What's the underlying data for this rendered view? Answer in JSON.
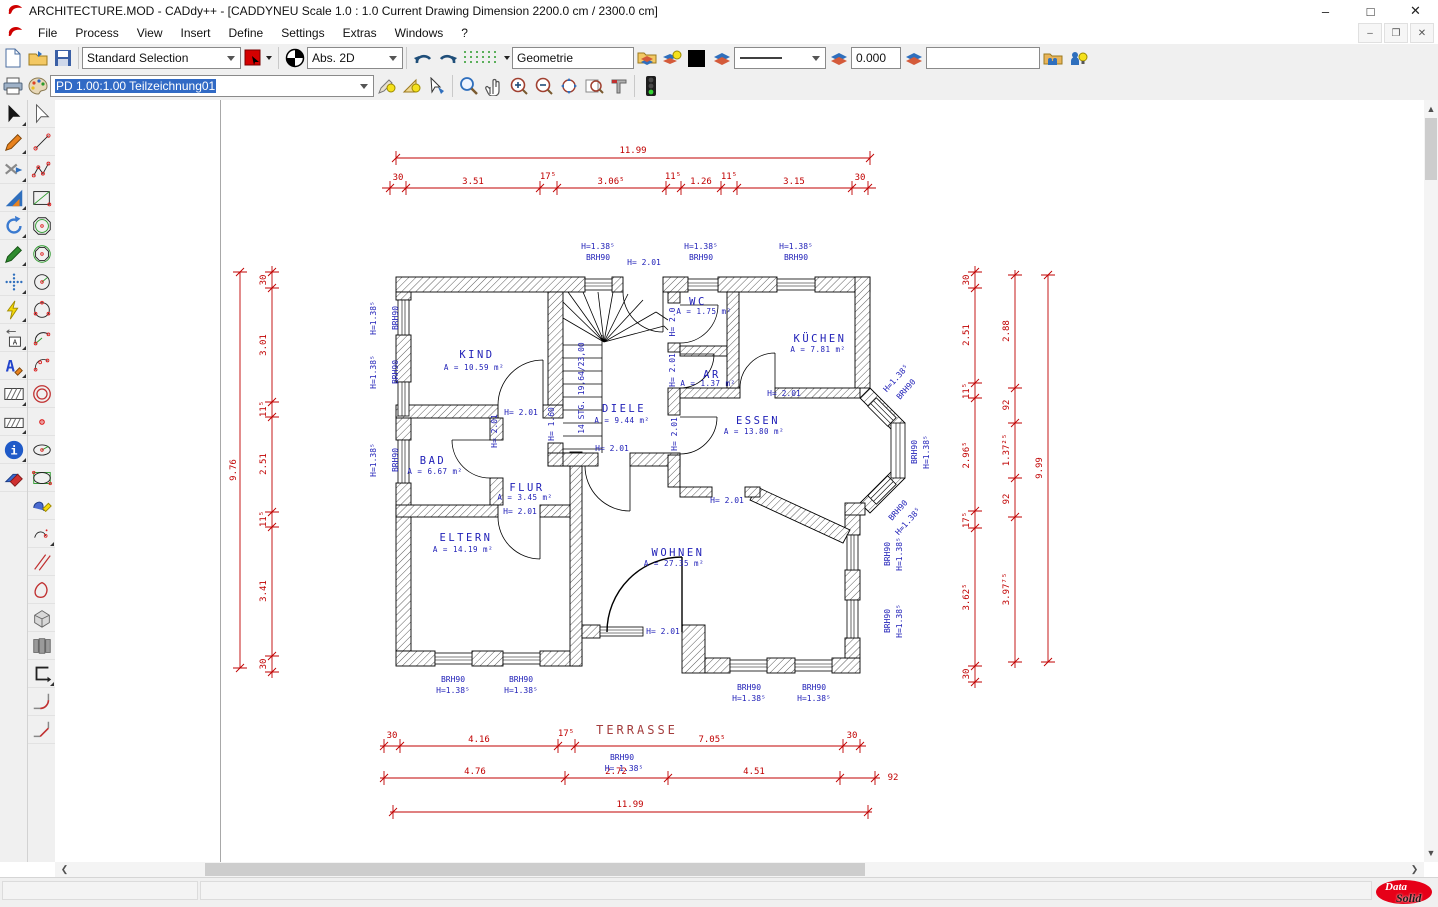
{
  "window": {
    "title": "ARCHITECTURE.MOD  -  CADdy++  - [CADDYNEU   Scale 1.0 : 1.0   Current Drawing Dimension 2200.0 cm / 2300.0 cm]",
    "minimize": "–",
    "maximize": "□",
    "close": "✕"
  },
  "menu": {
    "items": [
      "File",
      "Process",
      "View",
      "Insert",
      "Define",
      "Settings",
      "Extras",
      "Windows",
      "?"
    ]
  },
  "toolbar1": {
    "selection_combo": "Standard Selection",
    "coord_combo": "Abs. 2D",
    "layer_input": "Geometrie",
    "angle_input": "0.000",
    "extra_input": ""
  },
  "toolbar2": {
    "drawing_combo": "PD 1.00:1.00 Teilzeichnung01"
  },
  "plan": {
    "rooms": [
      {
        "name": "KIND",
        "area": "A = 10.59 m²"
      },
      {
        "name": "DIELE",
        "area": "A = 9.44 m²"
      },
      {
        "name": "WC",
        "area": "A = 1.75 m²"
      },
      {
        "name": "KÜCHEN",
        "area": "A = 7.81 m²"
      },
      {
        "name": "AR",
        "area": "A = 1.37 m²"
      },
      {
        "name": "ESSEN",
        "area": "A = 13.80 m²"
      },
      {
        "name": "BAD",
        "area": "A = 6.67 m²"
      },
      {
        "name": "FLUR",
        "area": "A = 3.45 m²"
      },
      {
        "name": "ELTERN",
        "area": "A = 14.19 m²"
      },
      {
        "name": "WOHNEN",
        "area": "A = 27.35 m²"
      }
    ],
    "terrasse": "TERRASSE",
    "stairs": "14 STG. 19,64/23,00",
    "ann": {
      "h201": "H= 2.01",
      "h20": "H= 2.0",
      "h138": "H=1.38⁵",
      "h138sp": "H= 1.38⁵",
      "brh": "BRH90",
      "h160": "H= 1.60"
    },
    "dims": {
      "top_total": "11.99",
      "top_chain": [
        "30",
        "3.51",
        "17⁵",
        "3.06⁵",
        "11⁵",
        "1.26",
        "11⁵",
        "3.15",
        "30"
      ],
      "left_total": "9.76",
      "left_chain": [
        "30",
        "3.01",
        "11⁵",
        "2.51",
        "11⁵",
        "3.41",
        "30"
      ],
      "right_chain1": [
        "30",
        "2.51",
        "11⁵",
        "2.96⁵",
        "17⁵",
        "3.62⁵",
        "30"
      ],
      "right_chain2": [
        "2.88",
        "92",
        "1.37²⁵",
        "92",
        "3.97⁷⁵"
      ],
      "right_total": "9.99",
      "bottom_chain1": [
        "30",
        "4.16",
        "17⁵",
        "7.05⁵",
        "30"
      ],
      "bottom_chain2": [
        "4.76",
        "2.72",
        "4.51",
        "92"
      ],
      "bottom_total": "11.99"
    }
  },
  "logo": {
    "top": "Data",
    "bottom": "Solid"
  }
}
